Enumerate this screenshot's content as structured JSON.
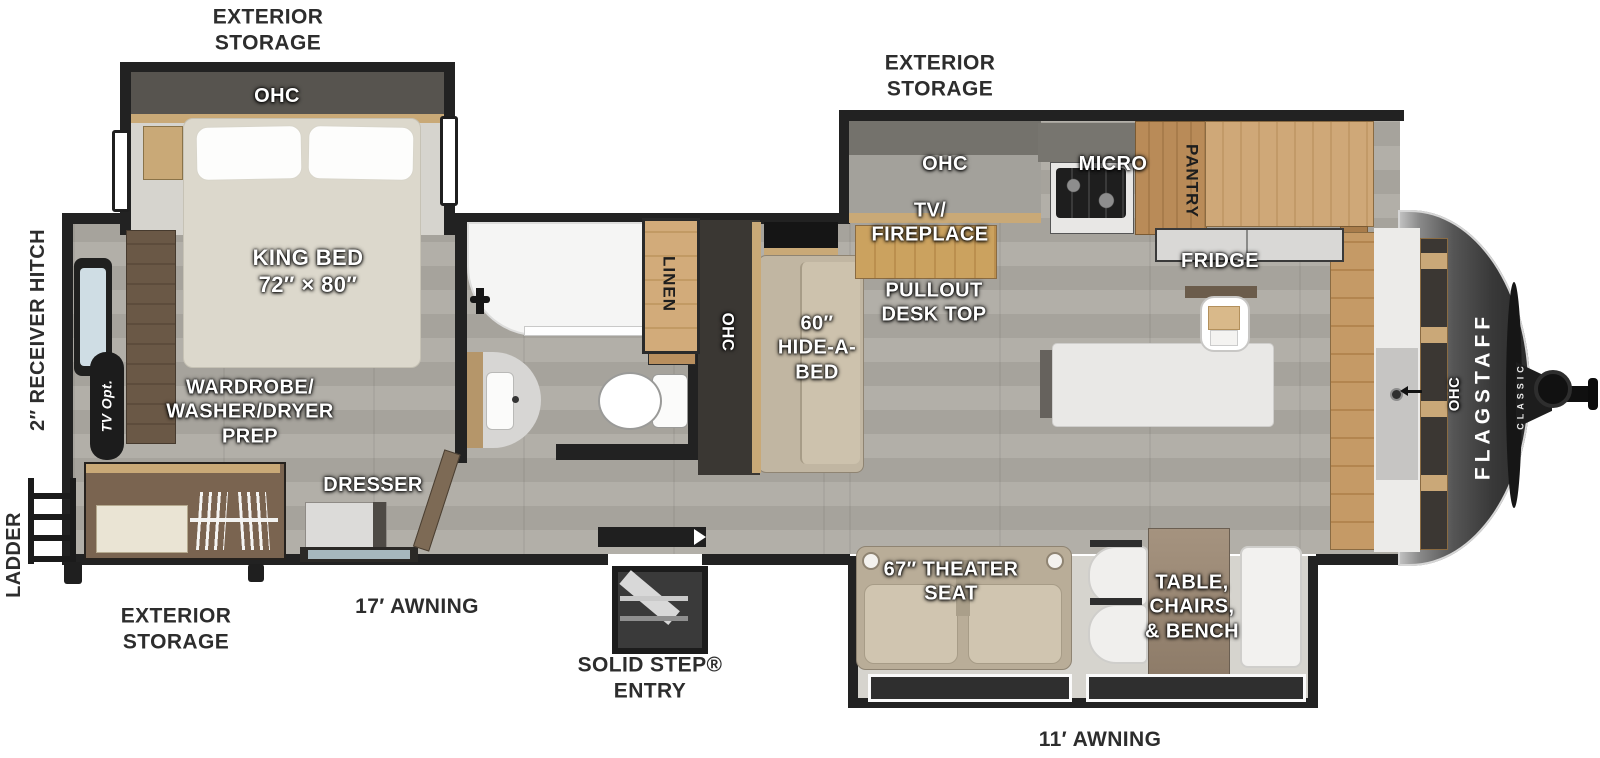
{
  "labels": {
    "exterior_storage_top_left": "EXTERIOR\nSTORAGE",
    "exterior_storage_top_right": "EXTERIOR\nSTORAGE",
    "exterior_storage_bottom_left": "EXTERIOR\nSTORAGE",
    "ohc_bedroom": "OHC",
    "king_bed": "KING BED\n72″ × 80″",
    "wardrobe_prep": "WARDROBE/\nWASHER/DRYER\nPREP",
    "dresser": "DRESSER",
    "tv_opt": "TV Opt.",
    "receiver_hitch": "2″ RECEIVER HITCH",
    "ladder": "LADDER",
    "awning_17": "17′ AWNING",
    "solid_step_entry": "SOLID STEP®\nENTRY",
    "linen": "LINEN",
    "ohc_hall": "OHC",
    "hide_a_bed": "60″\nHIDE-A-\nBED",
    "pullout_desk": "PULLOUT\nDESK TOP",
    "tv_fireplace": "TV/\nFIREPLACE",
    "ohc_kitchen": "OHC",
    "micro": "MICRO",
    "pantry": "PANTRY",
    "fridge": "FRIDGE",
    "theater_seat": "67″ THEATER\nSEAT",
    "table_chairs_bench": "TABLE,\nCHAIRS,\n& BENCH",
    "awning_11": "11′ AWNING",
    "ohc_front": "OHC",
    "logo_line1": "FLAGSTAFF",
    "logo_line2": "CLASSIC"
  },
  "colors": {
    "wall": "#222222",
    "wood": "#c9a470",
    "wood_dark": "#6e5a47",
    "floor": "#aca9a2",
    "slide_floor": "#d6d4ce",
    "bed": "#dcd8cc",
    "sofa": "#c1b6a2",
    "label_white": "#ffffff",
    "label_dark": "#2d2d2d",
    "front_cap": "#4a4a4a"
  }
}
